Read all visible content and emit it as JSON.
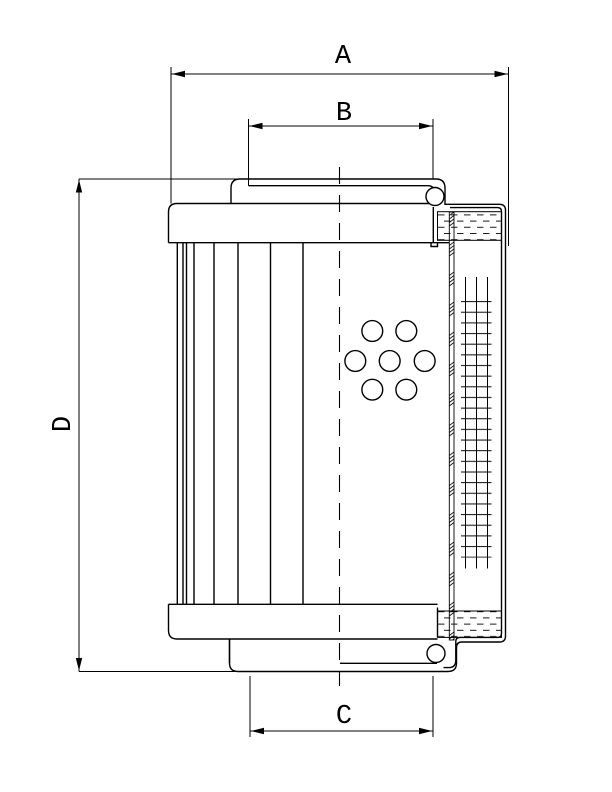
{
  "page": {
    "background": "#ffffff",
    "line_color": "#000000"
  },
  "dimensions": {
    "a": "A",
    "b": "B",
    "c": "C",
    "d": "D"
  }
}
